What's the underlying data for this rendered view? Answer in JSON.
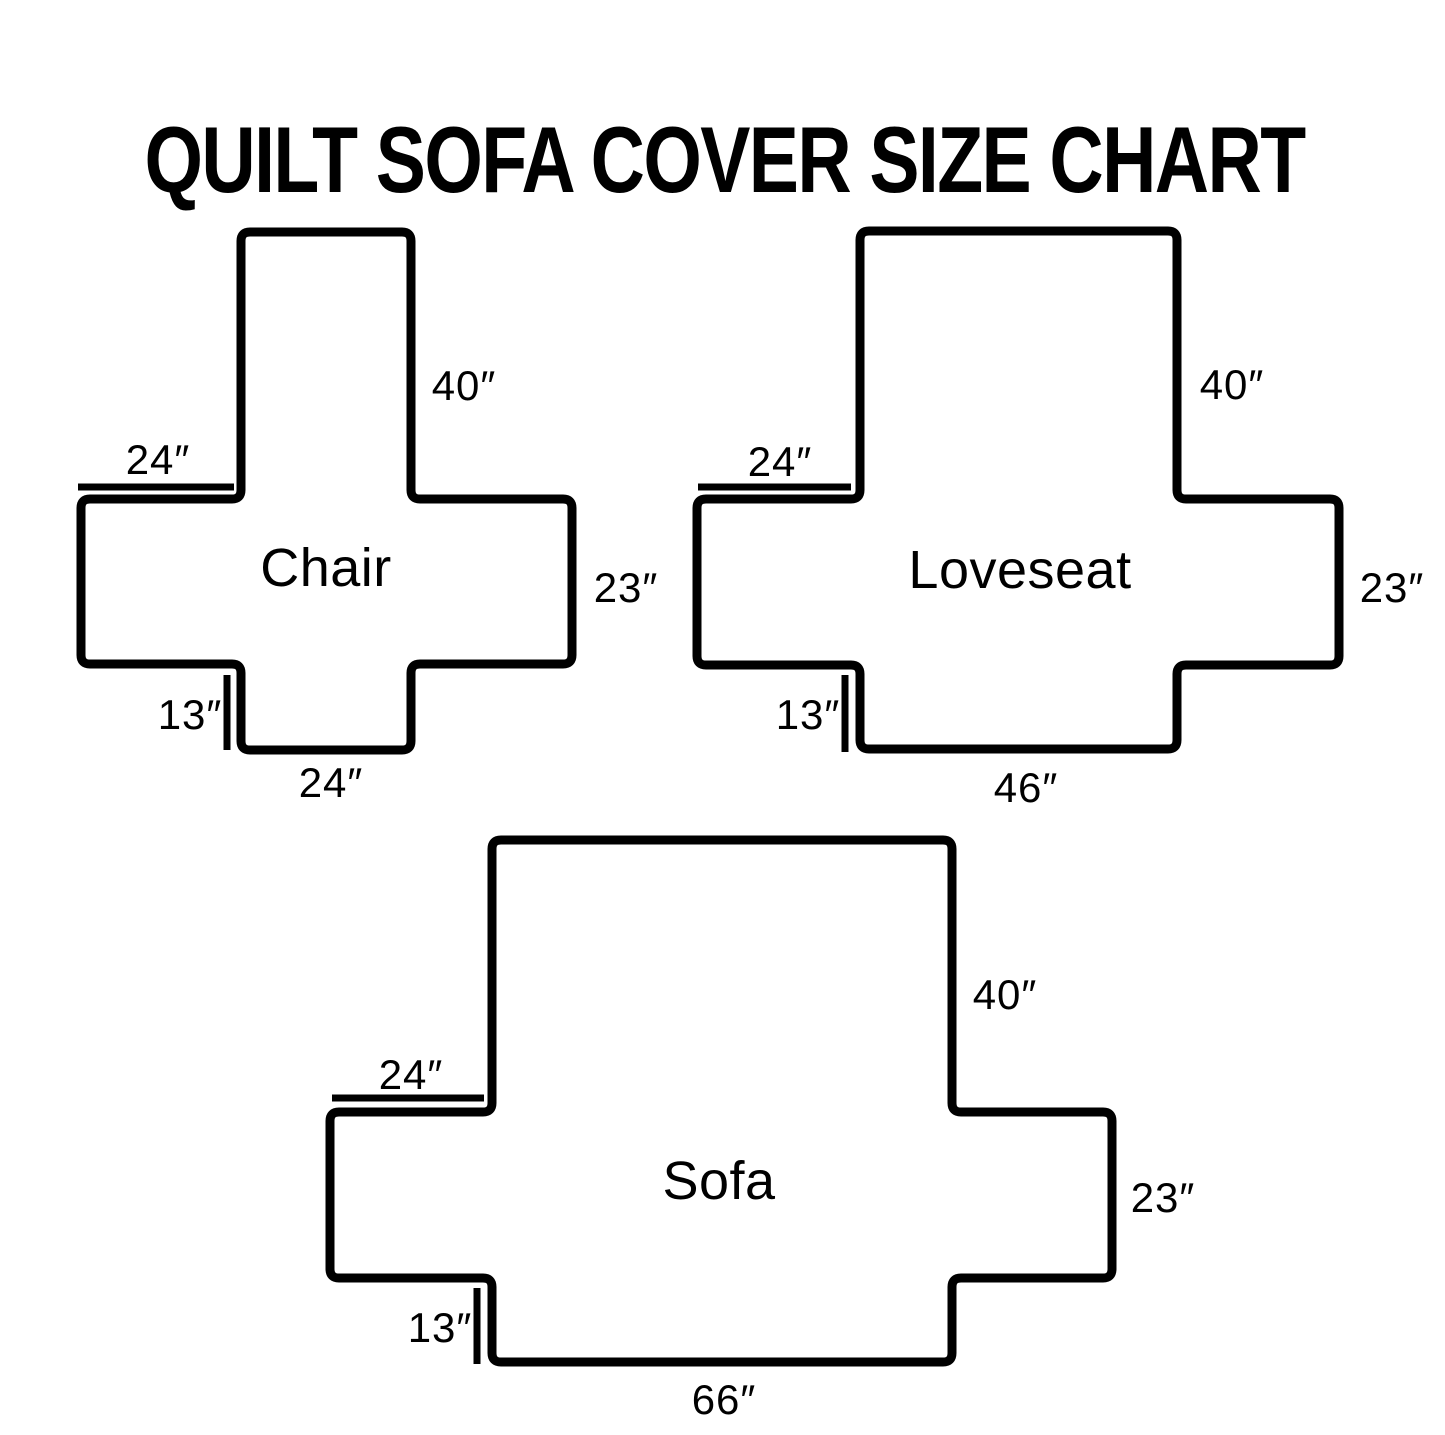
{
  "title": "QUILT SOFA COVER SIZE CHART",
  "colors": {
    "ink": "#000000",
    "background": "#ffffff"
  },
  "diagrams": [
    {
      "id": "chair",
      "name": "Chair",
      "dimensions": {
        "back_height": "40″",
        "top_arm_width": "24″",
        "side_height": "23″",
        "flap_height": "13″",
        "bottom_width": "24″"
      },
      "geometry": {
        "back": {
          "x1": 241,
          "x2": 411,
          "top": 232
        },
        "body": {
          "x1": 81,
          "x2": 572,
          "y1": 499,
          "y2": 664
        },
        "flap_bottom": 750,
        "dim_top_line": {
          "x1": 78,
          "x2": 234,
          "y": 487
        },
        "dim_left_line": {
          "x": 227,
          "y1": 675,
          "y2": 750
        }
      },
      "label_positions": {
        "back_height": {
          "x": 464,
          "y": 386
        },
        "top_arm_width": {
          "x": 158,
          "y": 460
        },
        "name": {
          "x": 326,
          "y": 568
        },
        "side_height": {
          "x": 626,
          "y": 588
        },
        "flap_height": {
          "x": 190,
          "y": 715
        },
        "bottom_width": {
          "x": 331,
          "y": 783
        }
      }
    },
    {
      "id": "loveseat",
      "name": "Loveseat",
      "dimensions": {
        "back_height": "40″",
        "top_arm_width": "24″",
        "side_height": "23″",
        "flap_height": "13″",
        "bottom_width": "46″"
      },
      "geometry": {
        "back": {
          "x1": 860,
          "x2": 1177,
          "top": 231
        },
        "body": {
          "x1": 697,
          "x2": 1339,
          "y1": 499,
          "y2": 665
        },
        "flap_bottom": 749,
        "dim_top_line": {
          "x1": 698,
          "x2": 851,
          "y": 487
        },
        "dim_left_line": {
          "x": 845,
          "y1": 675,
          "y2": 752
        }
      },
      "label_positions": {
        "back_height": {
          "x": 1232,
          "y": 385
        },
        "top_arm_width": {
          "x": 780,
          "y": 462
        },
        "name": {
          "x": 1020,
          "y": 570
        },
        "side_height": {
          "x": 1392,
          "y": 588
        },
        "flap_height": {
          "x": 808,
          "y": 715
        },
        "bottom_width": {
          "x": 1026,
          "y": 788
        }
      }
    },
    {
      "id": "sofa",
      "name": "Sofa",
      "dimensions": {
        "back_height": "40″",
        "top_arm_width": "24″",
        "side_height": "23″",
        "flap_height": "13″",
        "bottom_width": "66″"
      },
      "geometry": {
        "back": {
          "x1": 492,
          "x2": 952,
          "top": 840
        },
        "body": {
          "x1": 330,
          "x2": 1112,
          "y1": 1112,
          "y2": 1278
        },
        "flap_bottom": 1362,
        "dim_top_line": {
          "x1": 332,
          "x2": 484,
          "y": 1098
        },
        "dim_left_line": {
          "x": 477,
          "y1": 1288,
          "y2": 1364
        }
      },
      "label_positions": {
        "back_height": {
          "x": 1005,
          "y": 995
        },
        "top_arm_width": {
          "x": 411,
          "y": 1075
        },
        "name": {
          "x": 719,
          "y": 1181
        },
        "side_height": {
          "x": 1163,
          "y": 1198
        },
        "flap_height": {
          "x": 440,
          "y": 1328
        },
        "bottom_width": {
          "x": 724,
          "y": 1400
        }
      }
    }
  ]
}
